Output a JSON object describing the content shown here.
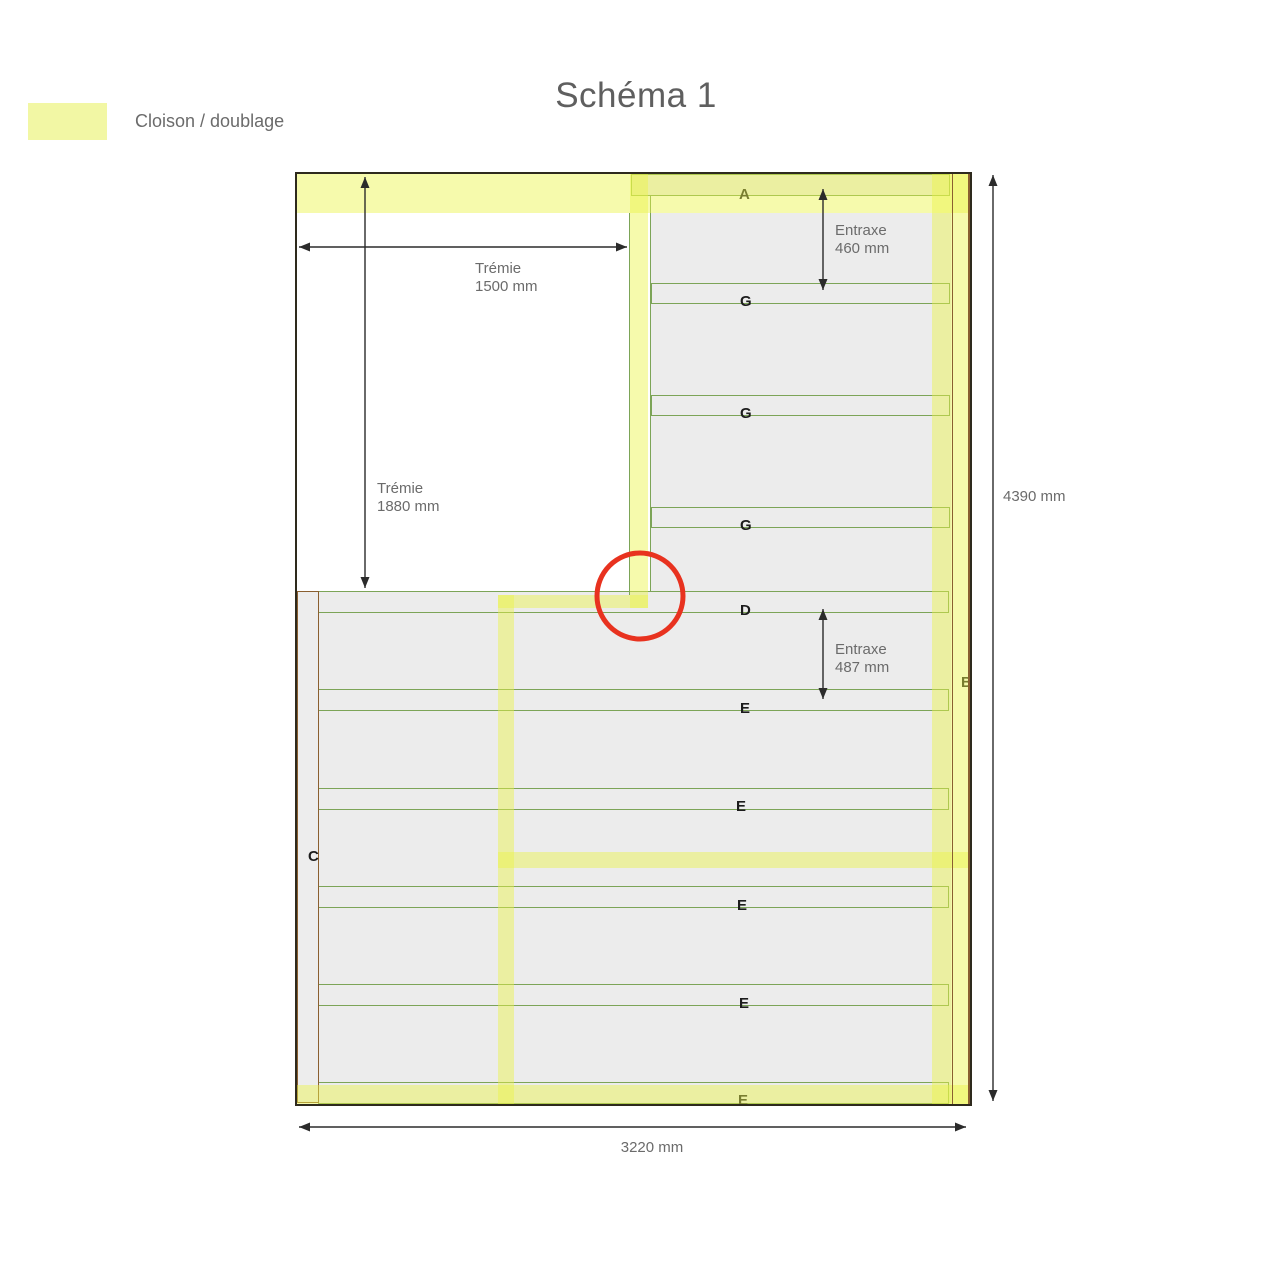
{
  "title": "Schéma 1",
  "legend": {
    "label": "Cloison / doublage",
    "swatch_color": "#f2f7a4"
  },
  "colors": {
    "band_yellow": "rgba(236,243,72,0.45)",
    "green": "#7ca457",
    "gray": "#ececec",
    "brown": "#8a5f30",
    "red_circle": "#e8321f",
    "frame": "#2e2a1d",
    "dim_text": "#6b6b6b",
    "label_text": "#1c1c1c",
    "title_text": "#5f5f5f"
  },
  "diagram": {
    "frame": {
      "x": 294.5,
      "y": 171.5,
      "w": 677,
      "h": 934
    },
    "gray_regions": [
      {
        "id": "upper-right-interior",
        "x": 651,
        "y": 213,
        "w": 300,
        "h": 378
      },
      {
        "id": "lower-interior",
        "x": 297,
        "y": 591,
        "w": 654,
        "h": 512
      }
    ],
    "strips": [
      {
        "id": "A",
        "label": "A",
        "x": 630.5,
        "y": 173.5,
        "w": 319,
        "h": 22,
        "lx": 739,
        "ly": 186
      },
      {
        "id": "G1",
        "label": "G",
        "x": 651,
        "y": 283,
        "w": 299,
        "h": 20.5,
        "lx": 740,
        "ly": 293
      },
      {
        "id": "G2",
        "label": "G",
        "x": 651,
        "y": 395,
        "w": 299,
        "h": 20.5,
        "lx": 740,
        "ly": 405
      },
      {
        "id": "G3",
        "label": "G",
        "x": 651,
        "y": 507,
        "w": 299,
        "h": 20.5,
        "lx": 740,
        "ly": 517
      },
      {
        "id": "D",
        "label": "D",
        "x": 318,
        "y": 591,
        "w": 631,
        "h": 22,
        "lx": 740,
        "ly": 602
      },
      {
        "id": "E1",
        "label": "E",
        "x": 318,
        "y": 689,
        "w": 631,
        "h": 22,
        "lx": 740,
        "ly": 700
      },
      {
        "id": "E2",
        "label": "E",
        "x": 318,
        "y": 787.5,
        "w": 631,
        "h": 22,
        "lx": 736,
        "ly": 798
      },
      {
        "id": "E3",
        "label": "E",
        "x": 318,
        "y": 886,
        "w": 631,
        "h": 22,
        "lx": 737,
        "ly": 897
      },
      {
        "id": "E4",
        "label": "E",
        "x": 318,
        "y": 984,
        "w": 631,
        "h": 22,
        "lx": 739,
        "ly": 995
      },
      {
        "id": "E5",
        "label": "E",
        "x": 318,
        "y": 1081.5,
        "w": 631,
        "h": 22,
        "lx": 738,
        "ly": 1092
      }
    ],
    "c_column": {
      "label": "C",
      "x": 296.5,
      "y": 591,
      "w": 22,
      "h": 512,
      "lx": 308,
      "ly": 848
    },
    "b_label": {
      "label": "B",
      "lx": 961,
      "ly": 674
    },
    "bands": [
      {
        "id": "cloison-top",
        "x": 297,
        "y": 174,
        "w": 672,
        "h": 39
      },
      {
        "id": "cloison-bottom",
        "x": 297,
        "y": 1085,
        "w": 672,
        "h": 18.5
      },
      {
        "id": "cloison-right-inner",
        "x": 931.5,
        "y": 174,
        "w": 20,
        "h": 929.5
      },
      {
        "id": "cloison-col-B",
        "x": 953,
        "y": 174,
        "w": 16.5,
        "h": 929.5
      },
      {
        "id": "cloison-upper-vertical",
        "x": 630,
        "y": 174,
        "w": 18,
        "h": 434
      },
      {
        "id": "cloison-jog",
        "x": 497.5,
        "y": 595,
        "w": 150.5,
        "h": 13
      },
      {
        "id": "cloison-lower-vertical",
        "x": 497.5,
        "y": 595,
        "w": 16.5,
        "h": 508.5
      },
      {
        "id": "cloison-mid-horizontal",
        "x": 497.5,
        "y": 851.5,
        "w": 471.5,
        "h": 16.5
      }
    ],
    "green_lines": [
      {
        "x": 650,
        "y": 196,
        "w": 1.3,
        "h": 395
      },
      {
        "x": 629,
        "y": 213,
        "w": 1.3,
        "h": 382
      }
    ],
    "brown_lines": [
      {
        "x": 951.5,
        "y": 174,
        "w": 1.5,
        "h": 929.5
      },
      {
        "x": 968,
        "y": 174,
        "w": 1.5,
        "h": 929.5
      }
    ],
    "dimensions": [
      {
        "id": "tremie-1500",
        "type": "h",
        "x1": 299,
        "x2": 627,
        "y": 247,
        "lines": [
          "Trémie",
          "1500 mm"
        ],
        "tx": 475,
        "ty": 260,
        "align": "left"
      },
      {
        "id": "tremie-1880",
        "type": "v",
        "x": 365,
        "y1": 177,
        "y2": 588,
        "lines": [
          "Trémie",
          "1880 mm"
        ],
        "tx": 377,
        "ty": 480,
        "align": "left"
      },
      {
        "id": "entraxe-460",
        "type": "v",
        "x": 823,
        "y1": 189,
        "y2": 290,
        "lines": [
          "Entraxe",
          "460 mm"
        ],
        "tx": 835,
        "ty": 222,
        "align": "left"
      },
      {
        "id": "entraxe-487",
        "type": "v",
        "x": 823,
        "y1": 609,
        "y2": 699,
        "lines": [
          "Entraxe",
          "487 mm"
        ],
        "tx": 835,
        "ty": 641,
        "align": "left"
      },
      {
        "id": "height-4390",
        "type": "v",
        "x": 993,
        "y1": 175,
        "y2": 1101,
        "lines": [
          "4390 mm"
        ],
        "tx": 1003,
        "ty": 488,
        "align": "left"
      },
      {
        "id": "width-3220",
        "type": "h",
        "x1": 299,
        "x2": 966,
        "y": 1127,
        "lines": [
          "3220 mm"
        ],
        "tx": 652,
        "ty": 1139,
        "align": "center"
      }
    ],
    "red_circle": {
      "cx": 640,
      "cy": 596,
      "r": 43,
      "stroke_width": 5
    }
  }
}
